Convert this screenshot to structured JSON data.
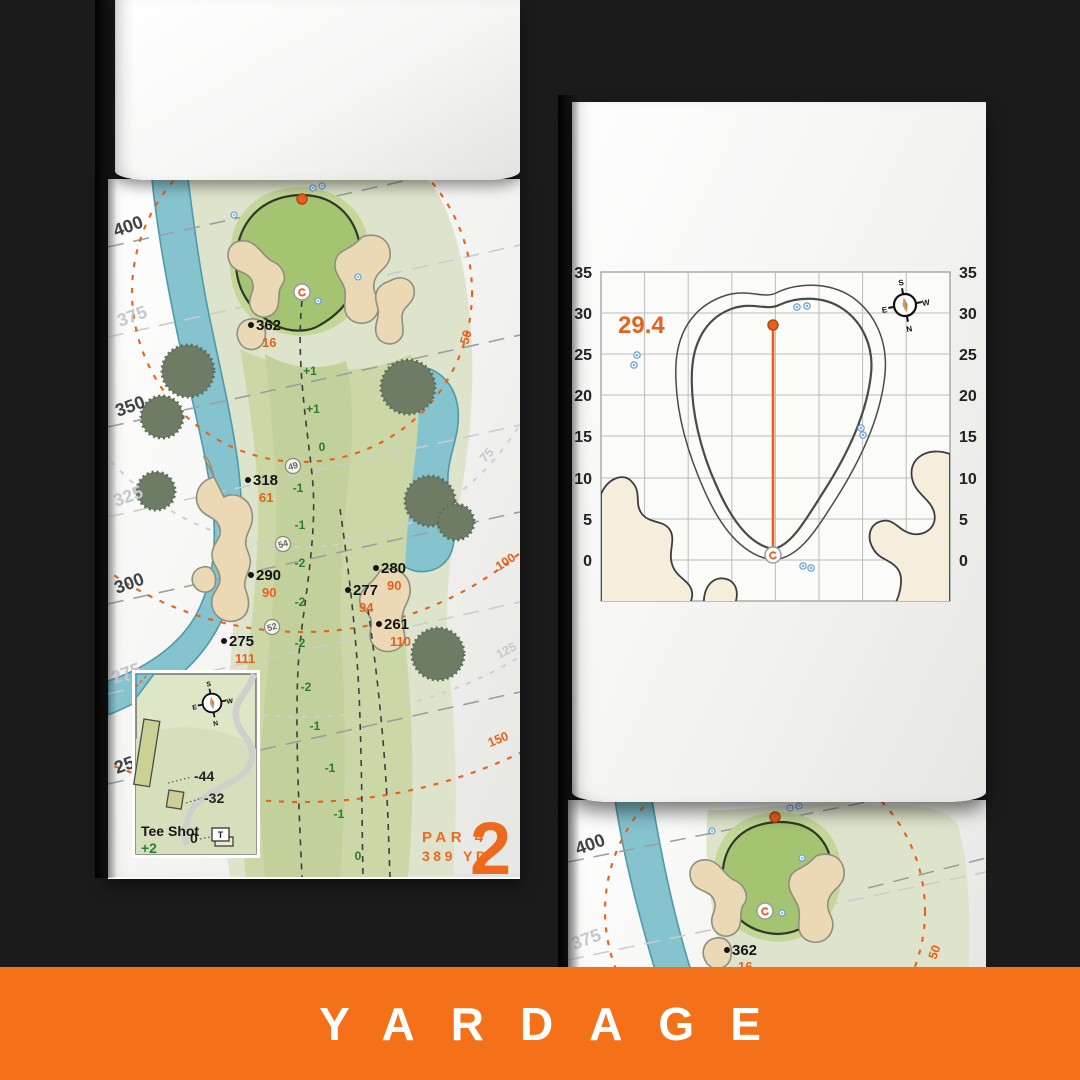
{
  "banner": {
    "label": "YARDAGE"
  },
  "compass": {
    "top": "S",
    "bottom": "N",
    "left": "E",
    "right": "W"
  },
  "hole_page": {
    "hole_number": "2",
    "par_label": "PAR 4",
    "yardage_label": "389 YD",
    "distance_lines": [
      {
        "label": "400",
        "tone": "dark"
      },
      {
        "label": "375",
        "tone": "light"
      },
      {
        "label": "350",
        "tone": "dark"
      },
      {
        "label": "325",
        "tone": "light"
      },
      {
        "label": "300",
        "tone": "dark"
      },
      {
        "label": "275",
        "tone": "light"
      },
      {
        "label": "250",
        "tone": "dark"
      }
    ],
    "arc_labels": [
      {
        "label": "50",
        "tone": "orange"
      },
      {
        "label": "75",
        "tone": "gray"
      },
      {
        "label": "100",
        "tone": "orange"
      },
      {
        "label": "125",
        "tone": "gray"
      },
      {
        "label": "150",
        "tone": "orange"
      }
    ],
    "carry_markers": [
      {
        "distance": "362",
        "to_front": "16"
      },
      {
        "distance": "318",
        "to_front": "61"
      },
      {
        "distance": "290",
        "to_front": "90"
      },
      {
        "distance": "280",
        "to_front": "90"
      },
      {
        "distance": "277",
        "to_front": "94"
      },
      {
        "distance": "261",
        "to_front": "110"
      },
      {
        "distance": "275",
        "to_front": "111"
      }
    ],
    "waypoints": [
      "49",
      "54",
      "52"
    ],
    "slopes": [
      "+1",
      "+1",
      "0",
      "-1",
      "-1",
      "-2",
      "-2",
      "-2",
      "-2",
      "-1",
      "-1",
      "-1",
      "0"
    ],
    "inset": {
      "title": "Tee Shot",
      "score": "+2",
      "long_tee": "-44",
      "short_tee": "-32",
      "zero": "0",
      "tee_marker": "T"
    }
  },
  "green_page": {
    "front_to_pin": "29.4",
    "axis_ticks": [
      "35",
      "30",
      "25",
      "20",
      "15",
      "10",
      "5",
      "0"
    ]
  },
  "next_hole_page": {
    "distance_lines": [
      {
        "label": "400",
        "tone": "dark"
      },
      {
        "label": "375",
        "tone": "light"
      }
    ],
    "carry_marker": {
      "distance": "362",
      "to_front": "16"
    },
    "arc_label": "50"
  },
  "colors": {
    "accent": "#ed6a1d",
    "banner": "#f4711a",
    "fairway": "#cbd7a6",
    "green": "#a4c471",
    "water": "#85c3cf",
    "bunker": "#ead9b4",
    "background": "#1b1b1b"
  },
  "chart_data": {
    "type": "table",
    "title": "Green depth grid (yards)",
    "axis_ticks": [
      35,
      30,
      25,
      20,
      15,
      10,
      5,
      0
    ],
    "front_to_pin_depth": 29.4
  }
}
